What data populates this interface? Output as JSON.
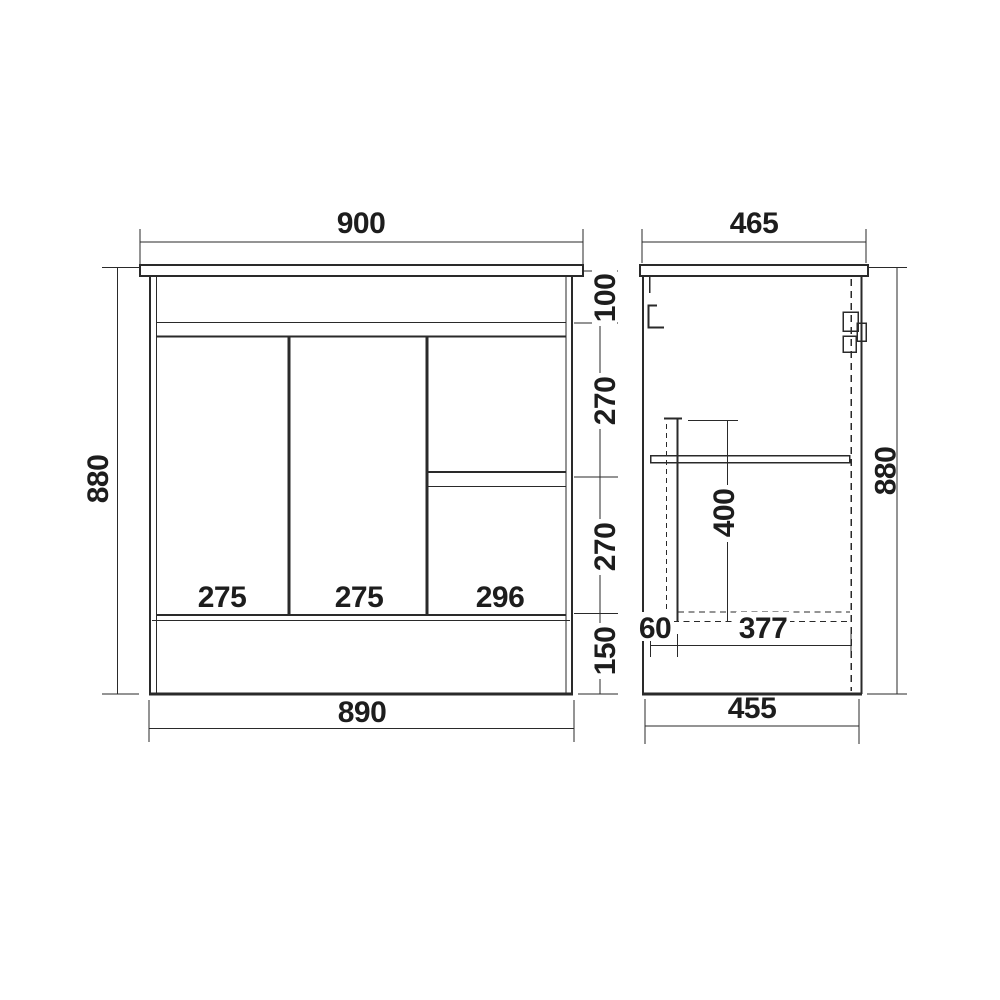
{
  "drawing": {
    "kind": "cabinet-technical-drawing",
    "line_color": "#2a2a2a",
    "background": "#ffffff",
    "front_view": {
      "top_width": "900",
      "height": "880",
      "bottom_width": "890",
      "top_section_height": "100",
      "upper_drawer_height": "270",
      "lower_drawer_height": "270",
      "kickboard_height": "150",
      "left_door_width": "275",
      "middle_door_width": "275",
      "drawer_bank_width": "296"
    },
    "side_view": {
      "top_depth": "465",
      "height": "880",
      "bottom_depth": "455",
      "internal_height": "400",
      "front_offset": "60",
      "internal_depth": "377"
    }
  }
}
